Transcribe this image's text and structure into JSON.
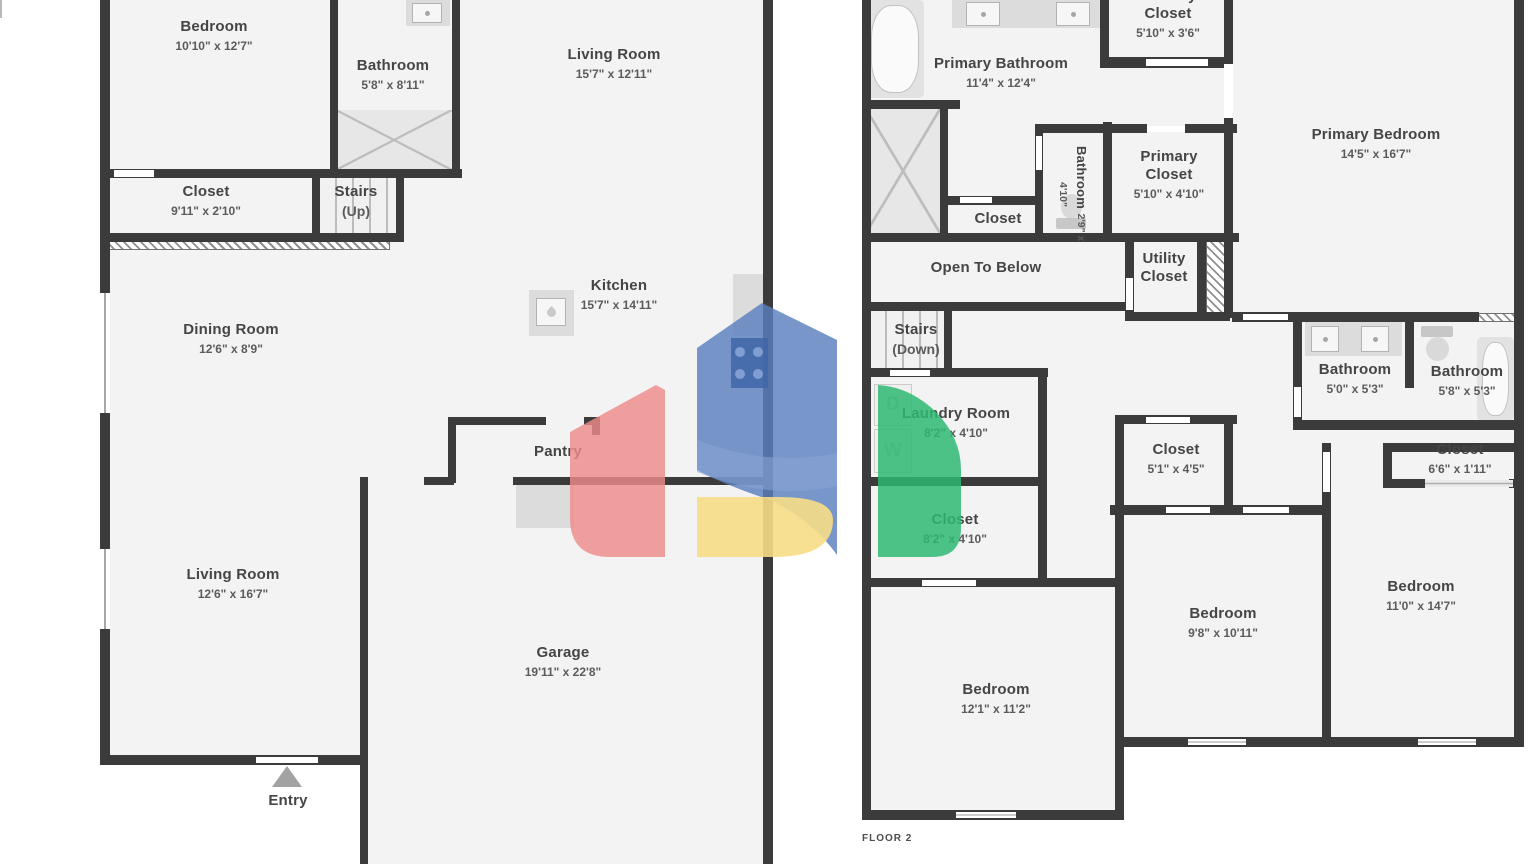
{
  "floor1": {
    "bedroom": {
      "name": "Bedroom",
      "dims": "10'10\" x 12'7\""
    },
    "bathroom": {
      "name": "Bathroom",
      "dims": "5'8\" x 8'11\""
    },
    "living_room_top": {
      "name": "Living Room",
      "dims": "15'7\" x 12'11\""
    },
    "closet": {
      "name": "Closet",
      "dims": "9'11\" x 2'10\""
    },
    "stairs": {
      "name": "Stairs",
      "dims": "(Up)"
    },
    "dining_room": {
      "name": "Dining Room",
      "dims": "12'6\" x 8'9\""
    },
    "kitchen": {
      "name": "Kitchen",
      "dims": "15'7\" x 14'11\""
    },
    "pantry": {
      "name": "Pantry"
    },
    "living_room": {
      "name": "Living Room",
      "dims": "12'6\" x 16'7\""
    },
    "garage": {
      "name": "Garage",
      "dims": "19'11\" x 22'8\""
    },
    "entry": {
      "name": "Entry"
    }
  },
  "floor2": {
    "primary_bathroom": {
      "name": "Primary Bathroom",
      "dims": "11'4\" x 12'4\""
    },
    "primary_closet_top": {
      "name": "Primary Closet",
      "dims": "5'10\" x 3'6\""
    },
    "bathroom_small": {
      "name": "Bathroom",
      "dims": "2'9\" x 4'10\""
    },
    "primary_closet": {
      "name": "Primary Closet",
      "dims": "5'10\" x 4'10\""
    },
    "closet_hall": {
      "name": "Closet"
    },
    "primary_bedroom": {
      "name": "Primary Bedroom",
      "dims": "14'5\" x 16'7\""
    },
    "open_to_below": {
      "name": "Open To Below"
    },
    "utility_closet": {
      "name": "Utility Closet"
    },
    "stairs_down": {
      "name": "Stairs",
      "dims": "(Down)"
    },
    "laundry_room": {
      "name": "Laundry Room",
      "dims": "8'2\" x 4'10\""
    },
    "closet_mid": {
      "name": "Closet",
      "dims": "8'2\" x 4'10\""
    },
    "bathroom_left": {
      "name": "Bathroom",
      "dims": "5'0\" x 5'3\""
    },
    "bathroom_right": {
      "name": "Bathroom",
      "dims": "5'8\" x 5'3\""
    },
    "closet_small": {
      "name": "Closet",
      "dims": "5'1\" x 4'5\""
    },
    "closet_narrow": {
      "name": "Closet",
      "dims": "6'6\" x 1'11\""
    },
    "bedroom_mid": {
      "name": "Bedroom",
      "dims": "9'8\" x 10'11\""
    },
    "bedroom_right": {
      "name": "Bedroom",
      "dims": "11'0\" x 14'7\""
    },
    "bedroom_bottom": {
      "name": "Bedroom",
      "dims": "12'1\" x 11'2\""
    },
    "washer": "W",
    "dryer": "D",
    "floor_label": "FLOOR 2"
  },
  "colors": {
    "wall": "#3b3b3b",
    "floor_fill": "#f3f3f3",
    "logo_blue": "#5b7fc0",
    "logo_red": "#ee8b8b",
    "logo_green": "#2eb873",
    "logo_yellow": "#f6dd86"
  }
}
